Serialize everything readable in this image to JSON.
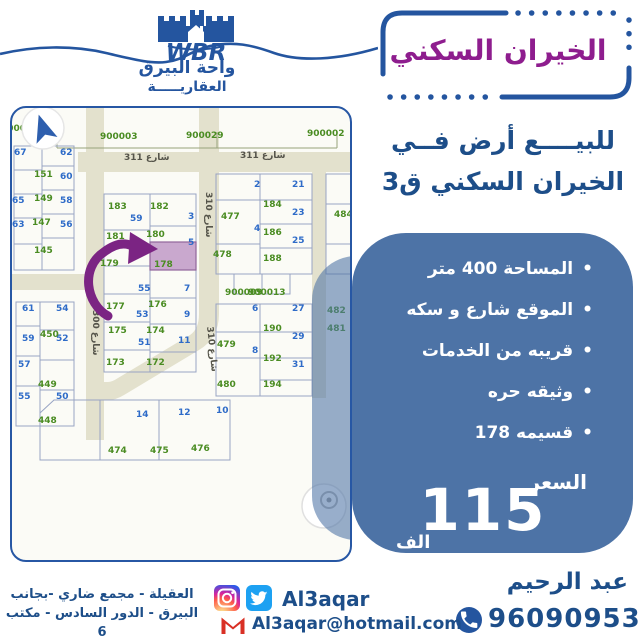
{
  "header": {
    "logo_initials": "WBR",
    "logo_line1": "واحة البيرق",
    "logo_line2": "العقاريـــــة",
    "title_badge": "الخيران السكني"
  },
  "offer": {
    "line1": "للبيــــع أرض فــي",
    "line2": "الخيران السكني ق3",
    "bullets": [
      "المساحة 400 متر",
      "الموقع شارع و سكه",
      "قريبه من الخدمات",
      "وثيقه حره",
      "قسيمه 178"
    ],
    "price_label": "السعر",
    "price_value": "115",
    "price_unit": "الف"
  },
  "contact": {
    "agent_name": "عبد الرحيم",
    "phone": "96090953",
    "social_handle": "Al3aqar",
    "email": "Al3aqar@hotmail.com",
    "address_line1": "العقيلة - مجمع ضاري -بجانب",
    "address_line2": "البيرق - الدور السادس - مكتب 6"
  },
  "colors": {
    "navy_text": "#1d4e89",
    "brand_blue": "#24559f",
    "badge_purple": "#8e1d8e",
    "box_blue": "#4d73a6",
    "street_beige": "#e3e1cd",
    "plot_number_blue": "#2e6bc8",
    "plot_number_green": "#4a8c22",
    "highlight_fill": "#c9a8ce",
    "arrow_purple": "#7b2483"
  },
  "map": {
    "highlighted_plot": "178",
    "labels": [
      {
        "t": "67",
        "x": 2,
        "y": 40,
        "c": "b"
      },
      {
        "t": "62",
        "x": 48,
        "y": 40,
        "c": "b"
      },
      {
        "t": "60",
        "x": 48,
        "y": 64,
        "c": "b"
      },
      {
        "t": "65",
        "x": 0,
        "y": 88,
        "c": "b"
      },
      {
        "t": "58",
        "x": 48,
        "y": 88,
        "c": "b"
      },
      {
        "t": "63",
        "x": 0,
        "y": 112,
        "c": "b"
      },
      {
        "t": "56",
        "x": 48,
        "y": 112,
        "c": "b"
      },
      {
        "t": "61",
        "x": 10,
        "y": 196,
        "c": "b"
      },
      {
        "t": "54",
        "x": 44,
        "y": 196,
        "c": "b"
      },
      {
        "t": "59",
        "x": 10,
        "y": 226,
        "c": "b"
      },
      {
        "t": "52",
        "x": 44,
        "y": 226,
        "c": "b"
      },
      {
        "t": "57",
        "x": 6,
        "y": 252,
        "c": "b"
      },
      {
        "t": "55",
        "x": 6,
        "y": 284,
        "c": "b"
      },
      {
        "t": "50",
        "x": 44,
        "y": 284,
        "c": "b"
      },
      {
        "t": "59",
        "x": 118,
        "y": 106,
        "c": "b"
      },
      {
        "t": "3",
        "x": 176,
        "y": 104,
        "c": "b"
      },
      {
        "t": "57",
        "x": 112,
        "y": 132,
        "c": "b"
      },
      {
        "t": "5",
        "x": 176,
        "y": 130,
        "c": "b"
      },
      {
        "t": "55",
        "x": 126,
        "y": 176,
        "c": "b"
      },
      {
        "t": "7",
        "x": 172,
        "y": 176,
        "c": "b"
      },
      {
        "t": "53",
        "x": 124,
        "y": 202,
        "c": "b"
      },
      {
        "t": "9",
        "x": 172,
        "y": 202,
        "c": "b"
      },
      {
        "t": "51",
        "x": 126,
        "y": 230,
        "c": "b"
      },
      {
        "t": "11",
        "x": 166,
        "y": 228,
        "c": "b"
      },
      {
        "t": "2",
        "x": 242,
        "y": 72,
        "c": "b"
      },
      {
        "t": "21",
        "x": 280,
        "y": 72,
        "c": "b"
      },
      {
        "t": "23",
        "x": 280,
        "y": 100,
        "c": "b"
      },
      {
        "t": "4",
        "x": 242,
        "y": 116,
        "c": "b"
      },
      {
        "t": "25",
        "x": 280,
        "y": 128,
        "c": "b"
      },
      {
        "t": "6",
        "x": 240,
        "y": 196,
        "c": "b"
      },
      {
        "t": "27",
        "x": 280,
        "y": 196,
        "c": "b"
      },
      {
        "t": "29",
        "x": 280,
        "y": 224,
        "c": "b"
      },
      {
        "t": "8",
        "x": 240,
        "y": 238,
        "c": "b"
      },
      {
        "t": "31",
        "x": 280,
        "y": 252,
        "c": "b"
      },
      {
        "t": "14",
        "x": 124,
        "y": 302,
        "c": "b"
      },
      {
        "t": "12",
        "x": 166,
        "y": 300,
        "c": "b"
      },
      {
        "t": "10",
        "x": 204,
        "y": 298,
        "c": "b"
      },
      {
        "t": "151",
        "x": 22,
        "y": 62,
        "c": "g"
      },
      {
        "t": "149",
        "x": 22,
        "y": 86,
        "c": "g"
      },
      {
        "t": "147",
        "x": 20,
        "y": 110,
        "c": "g"
      },
      {
        "t": "145",
        "x": 22,
        "y": 138,
        "c": "g"
      },
      {
        "t": "450",
        "x": 28,
        "y": 222,
        "c": "g"
      },
      {
        "t": "449",
        "x": 26,
        "y": 272,
        "c": "g"
      },
      {
        "t": "448",
        "x": 26,
        "y": 308,
        "c": "g"
      },
      {
        "t": "183",
        "x": 96,
        "y": 94,
        "c": "g"
      },
      {
        "t": "182",
        "x": 138,
        "y": 94,
        "c": "g"
      },
      {
        "t": "181",
        "x": 94,
        "y": 124,
        "c": "g"
      },
      {
        "t": "180",
        "x": 134,
        "y": 122,
        "c": "g"
      },
      {
        "t": "179",
        "x": 88,
        "y": 151,
        "c": "g"
      },
      {
        "t": "178",
        "x": 142,
        "y": 152,
        "c": "g"
      },
      {
        "t": "177",
        "x": 94,
        "y": 194,
        "c": "g"
      },
      {
        "t": "176",
        "x": 136,
        "y": 192,
        "c": "g"
      },
      {
        "t": "175",
        "x": 96,
        "y": 218,
        "c": "g"
      },
      {
        "t": "174",
        "x": 134,
        "y": 218,
        "c": "g"
      },
      {
        "t": "173",
        "x": 94,
        "y": 250,
        "c": "g"
      },
      {
        "t": "172",
        "x": 134,
        "y": 250,
        "c": "g"
      },
      {
        "t": "477",
        "x": 209,
        "y": 104,
        "c": "g"
      },
      {
        "t": "478",
        "x": 201,
        "y": 142,
        "c": "g"
      },
      {
        "t": "184",
        "x": 251,
        "y": 92,
        "c": "g"
      },
      {
        "t": "186",
        "x": 251,
        "y": 120,
        "c": "g"
      },
      {
        "t": "188",
        "x": 251,
        "y": 146,
        "c": "g"
      },
      {
        "t": "190",
        "x": 251,
        "y": 216,
        "c": "g"
      },
      {
        "t": "192",
        "x": 251,
        "y": 246,
        "c": "g"
      },
      {
        "t": "194",
        "x": 251,
        "y": 272,
        "c": "g"
      },
      {
        "t": "479",
        "x": 205,
        "y": 232,
        "c": "g"
      },
      {
        "t": "480",
        "x": 205,
        "y": 272,
        "c": "g"
      },
      {
        "t": "484",
        "x": 322,
        "y": 102,
        "c": "g"
      },
      {
        "t": "482",
        "x": 315,
        "y": 198,
        "c": "g"
      },
      {
        "t": "481",
        "x": 315,
        "y": 216,
        "c": "g"
      },
      {
        "t": "474",
        "x": 96,
        "y": 338,
        "c": "g"
      },
      {
        "t": "475",
        "x": 138,
        "y": 338,
        "c": "g"
      },
      {
        "t": "476",
        "x": 179,
        "y": 336,
        "c": "g"
      },
      {
        "t": "900003",
        "x": 88,
        "y": 24,
        "c": "g"
      },
      {
        "t": "900029",
        "x": 174,
        "y": 23,
        "c": "g"
      },
      {
        "t": "900002",
        "x": 295,
        "y": 21,
        "c": "g"
      },
      {
        "t": "900009",
        "x": 213,
        "y": 180,
        "c": "g"
      },
      {
        "t": "900013",
        "x": 236,
        "y": 180,
        "c": "g"
      },
      {
        "t": "9000",
        "x": -11,
        "y": 16,
        "c": "g"
      },
      {
        "t": "شارع 311",
        "x": 112,
        "y": 45,
        "c": "s"
      },
      {
        "t": "شارع 311",
        "x": 228,
        "y": 43,
        "c": "s"
      },
      {
        "t": "شارع 310",
        "x": 201,
        "y": 84,
        "c": "s",
        "r": 90
      },
      {
        "t": "شارع 310",
        "x": 202,
        "y": 218,
        "c": "s",
        "r": 84
      },
      {
        "t": "شارع 300",
        "x": 88,
        "y": 202,
        "c": "s",
        "r": 90
      }
    ]
  }
}
